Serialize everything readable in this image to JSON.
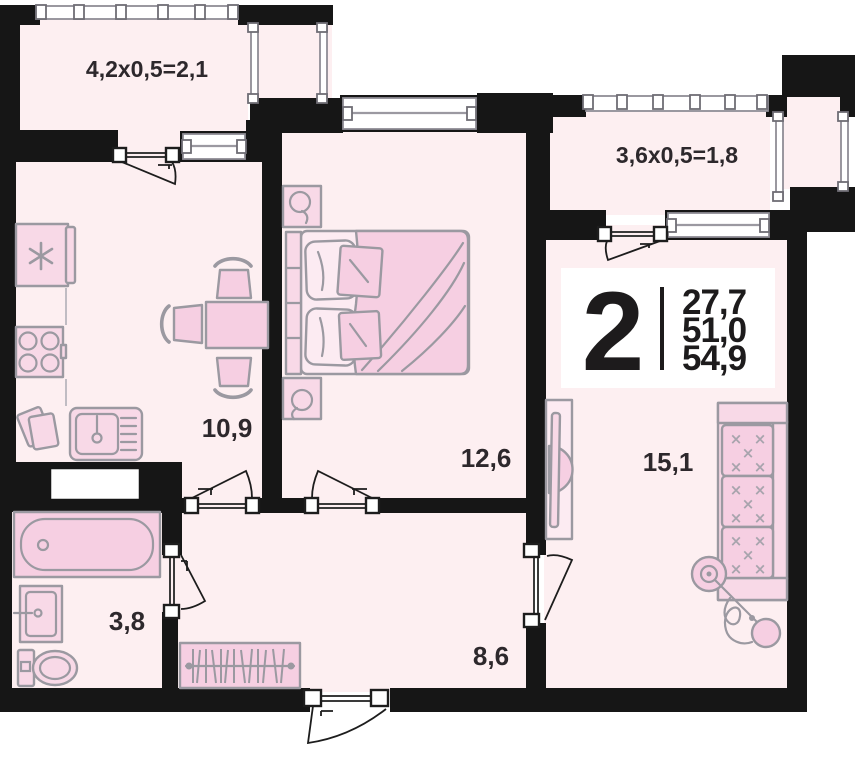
{
  "apartment": {
    "rooms_count": "2",
    "area_living": "27,7",
    "area_main": "51,0",
    "area_total": "54,9"
  },
  "rooms": {
    "kitchen": {
      "area": "10,9"
    },
    "bedroom": {
      "area": "12,6"
    },
    "living_room": {
      "area": "15,1"
    },
    "bathroom": {
      "area": "3,8"
    },
    "hallway": {
      "area": "8,6"
    }
  },
  "balconies": {
    "left": {
      "dimensions": "4,2x0,5=2,1"
    },
    "right": {
      "dimensions": "3,6x0,5=1,8"
    }
  },
  "colors": {
    "wall": "#161616",
    "room_fill": "#fdeff1",
    "furniture_fill": "#f8d9e7",
    "furniture_accent": "#f6cfe2",
    "furniture_stroke": "#9b99a1",
    "card_bg": "#ffffff",
    "text": "#2d282c"
  }
}
